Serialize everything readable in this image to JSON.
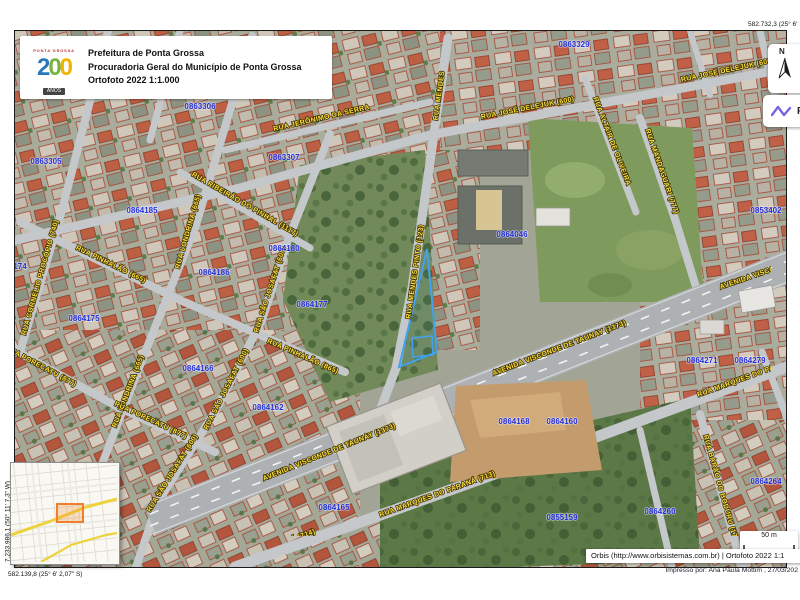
{
  "header": {
    "logo": {
      "top": "PONTA GROSSA",
      "d1": "2",
      "d2": "0",
      "d3": "0",
      "anos": "ANOS"
    },
    "lines": {
      "line1": "Prefeitura de Ponta Grossa",
      "line2": "Procuradoria Geral do Município de Ponta Grossa",
      "line3": "Ortofoto 2022 1:1.000"
    }
  },
  "coordinates": {
    "top_right": "582.732,3 (25° 6'",
    "bottom_left": "582.139,8 (25° 6' 2,07\" S)",
    "left_vertical": "7.233.986,1 (50° 11' 7,3\" W)"
  },
  "north_panel": {
    "label": "N"
  },
  "r_tool": {
    "label": "R"
  },
  "scalebar": {
    "label": "50 m"
  },
  "credits": {
    "line1": "Orbis (http://www.orbisistemas.com.br) | Ortofoto 2022 1:1",
    "line2": "Impresso por: Ana Paula Mottim , 27/03/202"
  },
  "map": {
    "street_label_color": "#ffdf3a",
    "parcel_label_color": "#2531d8",
    "parcel_outline_color": "#a84432",
    "selected_parcel_color": "#41a2f0",
    "inset_highlight_color": "#ef7f2e",
    "street_labels": [
      {
        "text": "RUA JOSÉ DELEJUK (600)",
        "x": 528,
        "y": 110,
        "rot": -11
      },
      {
        "text": "RUA JOSÉ DELEJUK (600)",
        "x": 728,
        "y": 72,
        "rot": -12
      },
      {
        "text": "RUA JERÔNIMO DA SERRA",
        "x": 322,
        "y": 120,
        "rot": -13
      },
      {
        "text": "RUA MENDES",
        "x": 441,
        "y": 96,
        "rot": -82
      },
      {
        "text": "RUA MENDES PINTO (123)",
        "x": 417,
        "y": 272,
        "rot": -82
      },
      {
        "text": "RUA ALTAIR DE OLIVEIRA",
        "x": 610,
        "y": 142,
        "rot": 69
      },
      {
        "text": "RUA MANDAGUARI (777)",
        "x": 660,
        "y": 172,
        "rot": 71
      },
      {
        "text": "RUA RIBEIRÃO DO PINHAL (1117)",
        "x": 244,
        "y": 206,
        "rot": 30
      },
      {
        "text": "RUA LONDRINA (665)",
        "x": 190,
        "y": 232,
        "rot": -74
      },
      {
        "text": "RUA LONDRINA (665)",
        "x": 130,
        "y": 392,
        "rot": -69
      },
      {
        "text": "RUA CORNÉLIO PROCÓPIO (740)",
        "x": 42,
        "y": 278,
        "rot": -74
      },
      {
        "text": "RUA PINHALÃO (665)",
        "x": 110,
        "y": 266,
        "rot": 26
      },
      {
        "text": "RUA PINHALÃO (865)",
        "x": 302,
        "y": 358,
        "rot": 24
      },
      {
        "text": "RUA SÃO JOSAFAT (600)",
        "x": 272,
        "y": 290,
        "rot": -72
      },
      {
        "text": "RUA SÃO JOSAFAT (600)",
        "x": 228,
        "y": 390,
        "rot": -63
      },
      {
        "text": "RUA SÃO JOSAFAT (600)",
        "x": 174,
        "y": 474,
        "rot": -58
      },
      {
        "text": "RUA PORECATU (877)",
        "x": 150,
        "y": 422,
        "rot": 25
      },
      {
        "text": "RUA PORECATU (877)",
        "x": 40,
        "y": 368,
        "rot": 28
      },
      {
        "text": "AVENIDA VISCONDE DE TAUNAY (1373)",
        "x": 330,
        "y": 454,
        "rot": -22
      },
      {
        "text": "AVENIDA VISCONDE DE TAUNAY (1373)",
        "x": 560,
        "y": 350,
        "rot": -21
      },
      {
        "text": "AVENIDA VISCONDE DE TAUNAY (1373)",
        "x": 788,
        "y": 266,
        "rot": -19
      },
      {
        "text": "RUA MARQUES DO PARANÁ (713)",
        "x": 438,
        "y": 496,
        "rot": -20
      },
      {
        "text": "RUA MARQUES DO PARANÁ (714)",
        "x": 258,
        "y": 554,
        "rot": -20
      },
      {
        "text": "RUA MARQUES DO PARANÁ (771)",
        "x": 756,
        "y": 376,
        "rot": -20
      },
      {
        "text": "RUA BARÃO DO BODURU (179)",
        "x": 719,
        "y": 490,
        "rot": 74
      },
      {
        "text": "RUA MARECHAL RONDON",
        "x": 791,
        "y": 352,
        "rot": 74
      }
    ],
    "parcel_labels": [
      {
        "text": "0863329",
        "x": 574,
        "y": 47
      },
      {
        "text": "0863306",
        "x": 200,
        "y": 109
      },
      {
        "text": "0863305",
        "x": 46,
        "y": 164
      },
      {
        "text": "0863307",
        "x": 284,
        "y": 160
      },
      {
        "text": "0864185",
        "x": 142,
        "y": 213
      },
      {
        "text": "0864186",
        "x": 214,
        "y": 275
      },
      {
        "text": "0864180",
        "x": 284,
        "y": 251
      },
      {
        "text": "0864177",
        "x": 312,
        "y": 307
      },
      {
        "text": "0864175",
        "x": 84,
        "y": 321
      },
      {
        "text": "174",
        "x": 20,
        "y": 269
      },
      {
        "text": "0864166",
        "x": 198,
        "y": 371
      },
      {
        "text": "0864162",
        "x": 268,
        "y": 410
      },
      {
        "text": "0864165",
        "x": 334,
        "y": 510
      },
      {
        "text": "0864168",
        "x": 514,
        "y": 424
      },
      {
        "text": "0864160",
        "x": 562,
        "y": 424
      },
      {
        "text": "0864046",
        "x": 512,
        "y": 237
      },
      {
        "text": "0853402",
        "x": 766,
        "y": 213
      },
      {
        "text": "0864271",
        "x": 702,
        "y": 363
      },
      {
        "text": "0864279",
        "x": 750,
        "y": 363
      },
      {
        "text": "0864264",
        "x": 766,
        "y": 484
      },
      {
        "text": "0864260",
        "x": 660,
        "y": 514
      },
      {
        "text": "0855159",
        "x": 562,
        "y": 520
      }
    ]
  }
}
